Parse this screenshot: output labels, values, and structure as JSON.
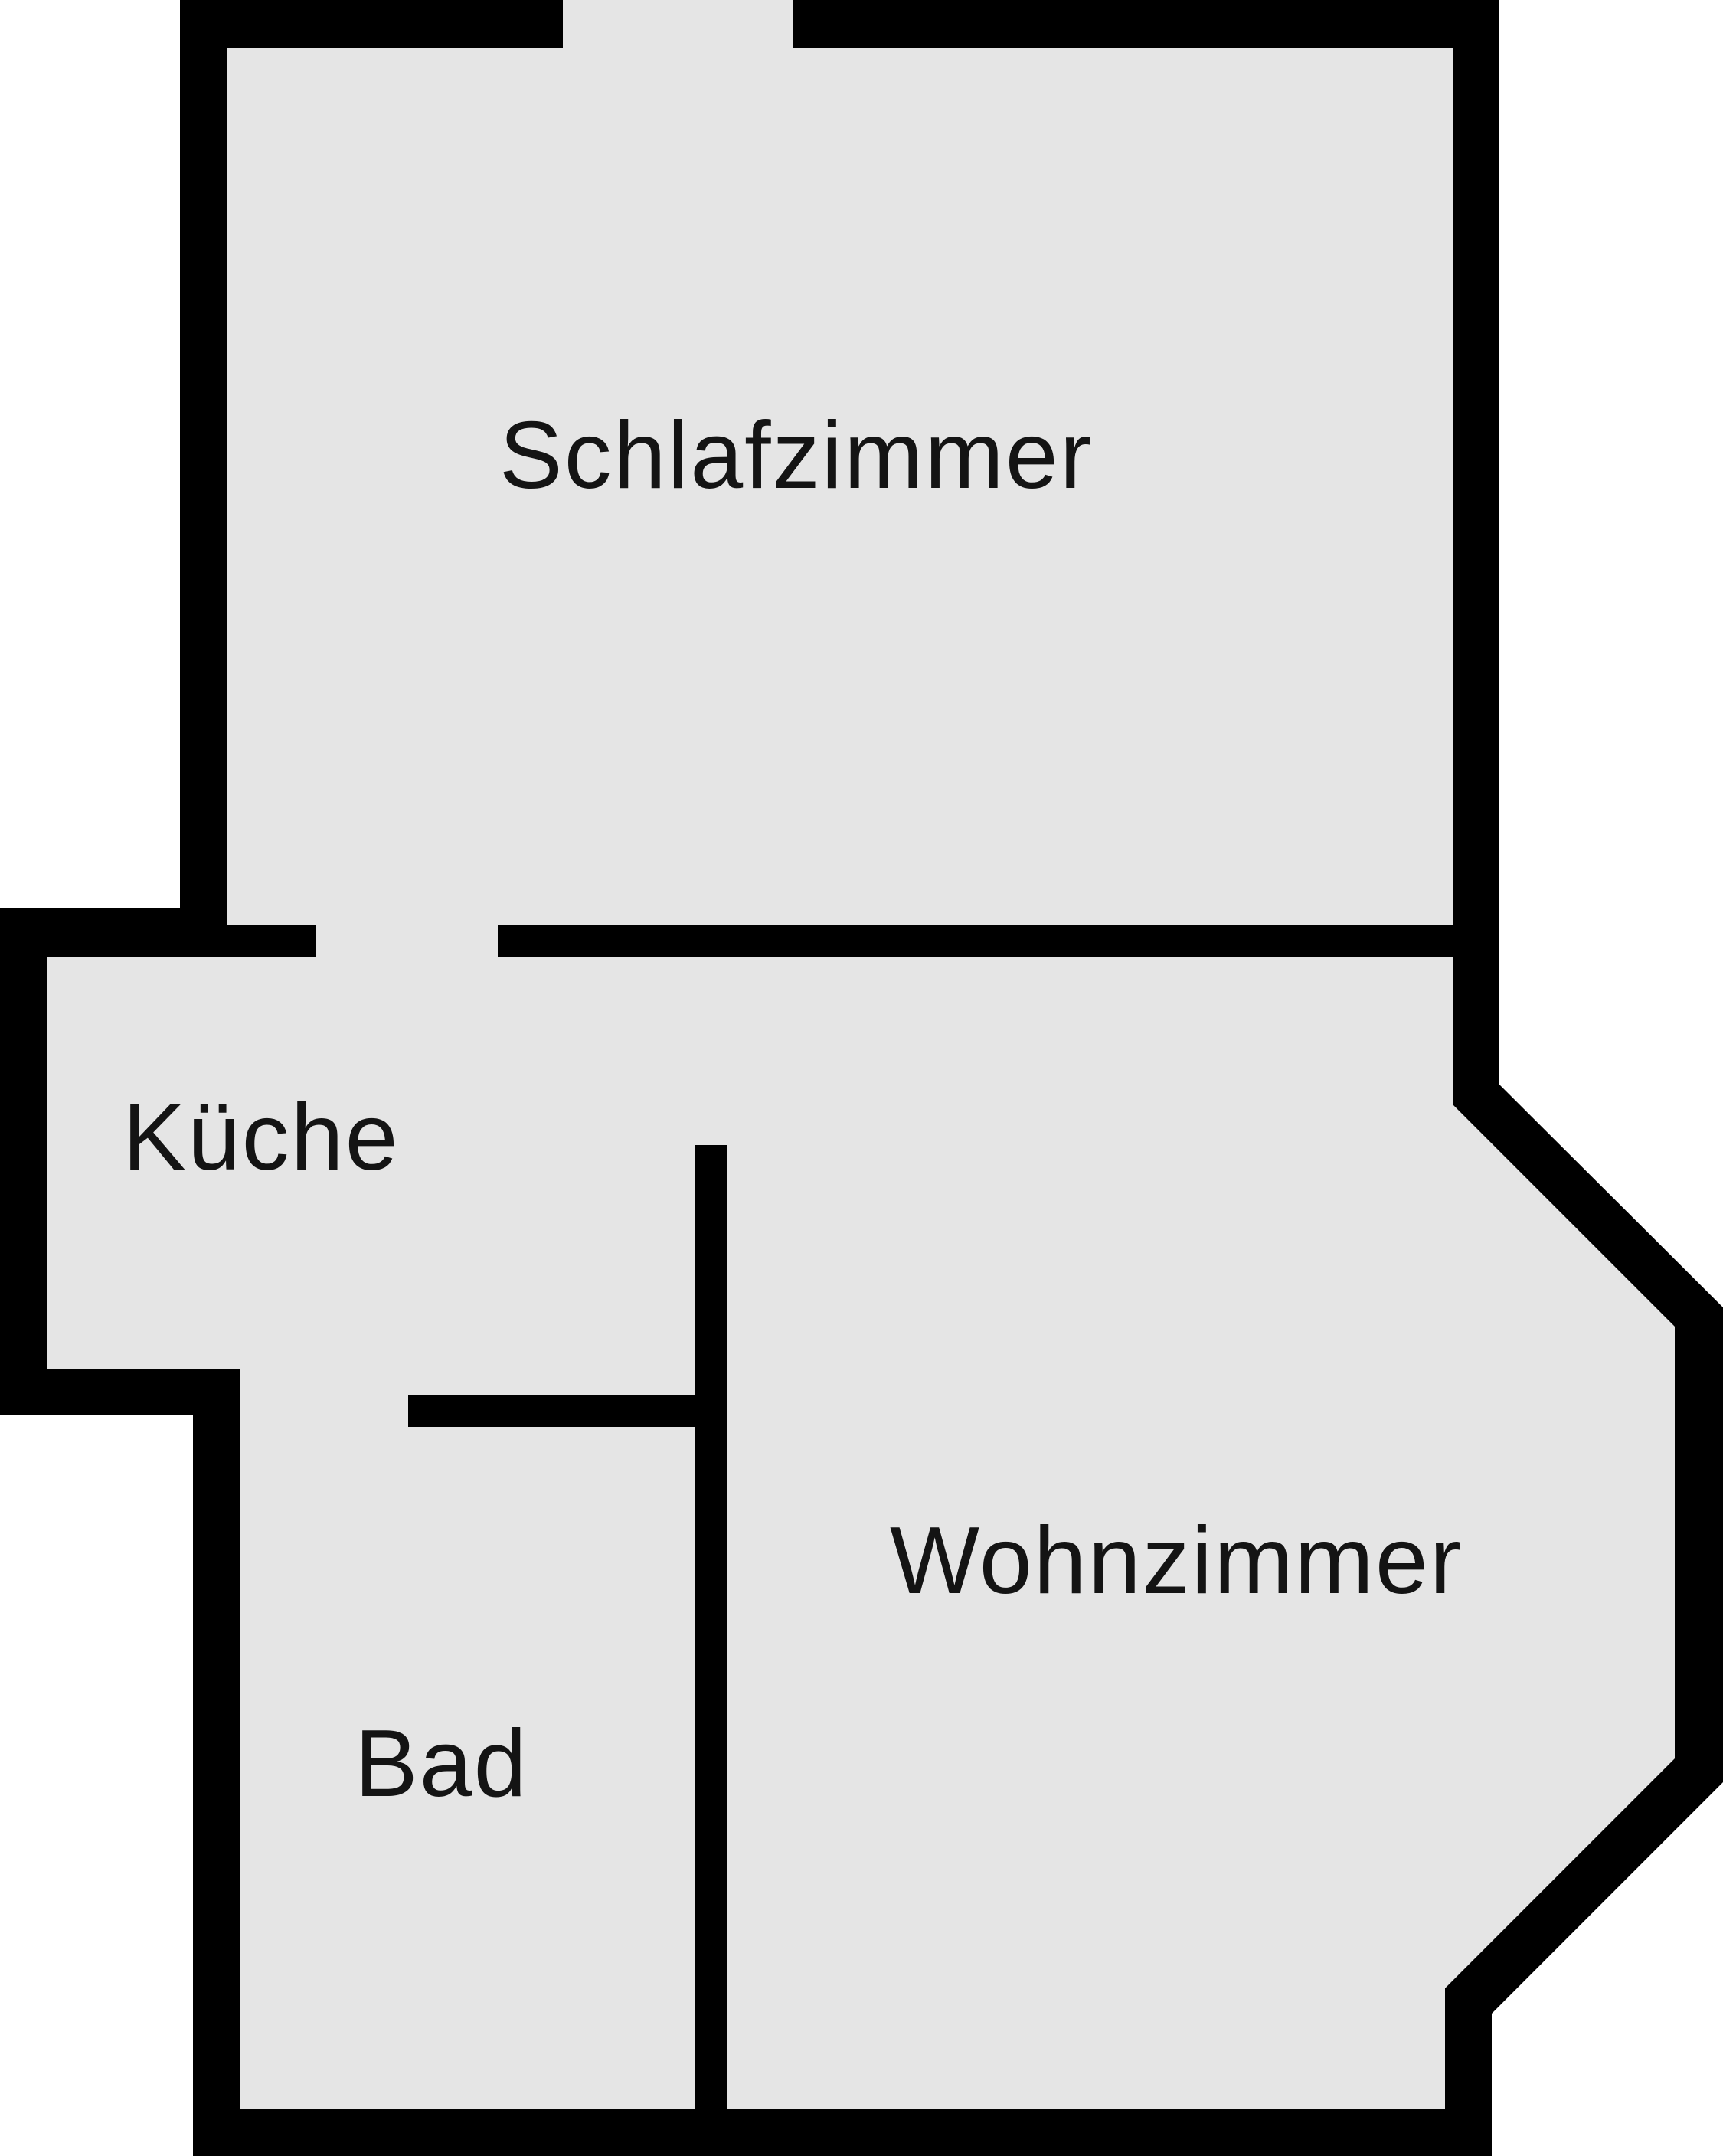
{
  "plan": {
    "type": "apartment-floor-plan",
    "rooms": [
      {
        "id": "schlafzimmer",
        "label": "Schlafzimmer"
      },
      {
        "id": "kueche",
        "label": "Küche"
      },
      {
        "id": "wohnzimmer",
        "label": "Wohnzimmer"
      },
      {
        "id": "bad",
        "label": "Bad"
      }
    ],
    "colors": {
      "wall": "#000000",
      "floor": "#e5e5e5",
      "background": "#ffffff",
      "label_text": "#141414"
    }
  }
}
